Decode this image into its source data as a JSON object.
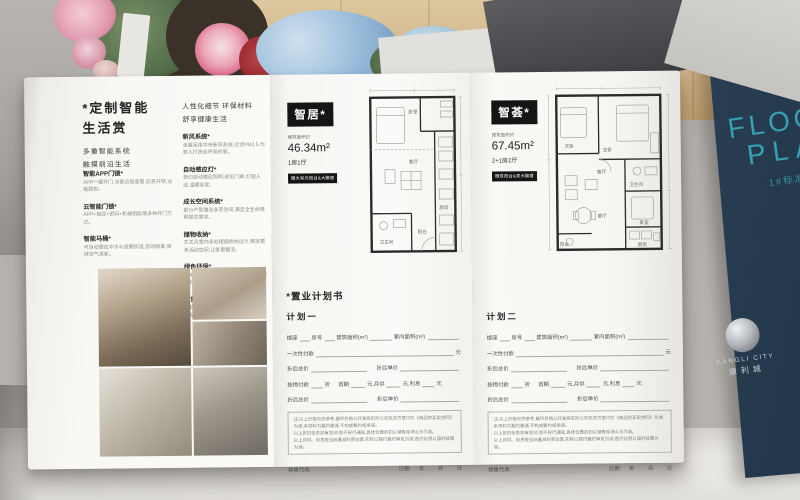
{
  "colors": {
    "navy": "#24384c",
    "teal": "#35a0b0",
    "badge_black": "#151515",
    "paper": "#f8f7f4",
    "wood": "#cfb386"
  },
  "left_panel": {
    "title": "*定制智能\n生活赏",
    "subtitle": "多重智能系统\n触摸前沿生活",
    "col1_items": [
      {
        "label": "智能APP门锁*",
        "desc": "APP一键开门,访客远程查看,应急开锁,远程授权。"
      },
      {
        "label": "云智能门锁*",
        "desc": "APP+指纹+密码+机械钥匙等多种开门方式。"
      },
      {
        "label": "智能马桶*",
        "desc": "可自动感应冲水与座圈加温,自动除臭,保持空气清新。"
      }
    ],
    "col2_header": "人性化细节 环保材料\n舒享健康生活",
    "col2_items": [
      {
        "label": "新风系统*",
        "desc": "全屋采用中央新风系统,过滤PM2.5,为家人打造会呼吸的家。"
      },
      {
        "label": "自动感应灯*",
        "desc": "夜归自动感应照明,进出门廊,灯随人动,温暖到家。"
      },
      {
        "label": "成长空间系统*",
        "desc": "部分户型赠送多变空间,满足全生命周期居住需求。"
      },
      {
        "label": "储物收纳*",
        "desc": "玄关及室内多处精细收纳设计,释放更多活动空间,让家更整洁。"
      },
      {
        "label": "绿色环保*",
        "desc": "采用绿色环保材料装修,甲醛含量低,健康舒适拎包入住。"
      },
      {
        "label": "智慧社区*",
        "desc": "以智慧产品终端为户主提供升级服务,全屋智能联动,生活更便捷。"
      }
    ]
  },
  "unit_cards": [
    {
      "name": "智居*",
      "area_label": "建筑面积约",
      "area": "46.34m²",
      "layout": "1房1厅",
      "bonus": "赠大采光阳台&大飘窗"
    },
    {
      "name": "智荟*",
      "area_label": "建筑面积约",
      "area": "67.45m²",
      "layout": "2+1房2厅",
      "bonus": "赠双阳台&双大飘窗"
    }
  ],
  "floorplans": [
    {
      "rooms": [
        "卧室",
        "客厅",
        "厨房",
        "卫生间",
        "阳台"
      ]
    },
    {
      "rooms": [
        "次卧",
        "主卧",
        "卫生间",
        "卧室",
        "厨房",
        "客厅",
        "餐厅",
        "阳台"
      ]
    }
  ],
  "purchase_form": {
    "title": "*置业计划书",
    "plan1": "计划一",
    "plan2": "计划二",
    "f_building": "楼座",
    "f_room": "房号",
    "f_area": "建筑面积(m²)",
    "f_inner_area": "套内面积(m²)",
    "f_onetime": "一次性付款",
    "unit_yuan_b": "元",
    "f_discount_total": "折后总价",
    "f_discount_unit": "折后单价",
    "f_mortgage": "按揭付款",
    "unit_zhe": "折",
    "f_first": "首期",
    "unit_yuan1": "元,",
    "f_monthly": "月供",
    "unit_yuan2": "元,",
    "f_interest": "利息",
    "unit_yuan3": "元",
    "note_lines": "注:以上价格仅供参考,最终价格以开发商实际公布及双方签订的《商品房买卖合同》为准,本资料为要约邀请,不构成要约或承诺。\n以上折扣信息如有变动,恕不另行通知,具体优惠折扣以销售现场公示为准。\n以上月供、利息按当前基准利率估算,实际以银行最终审批为准,首付比例以届时政策为准。",
    "f_sales": "销售代表:",
    "f_date": "日期:",
    "f_ymd": "年         月         日"
  },
  "cover": {
    "line1": "1#",
    "line2": "FLOOR",
    "line3": "PLAN",
    "subtitle": "1#标准层户型图",
    "brand_en": "KANGLI CITY",
    "brand_cn": "康利城"
  }
}
